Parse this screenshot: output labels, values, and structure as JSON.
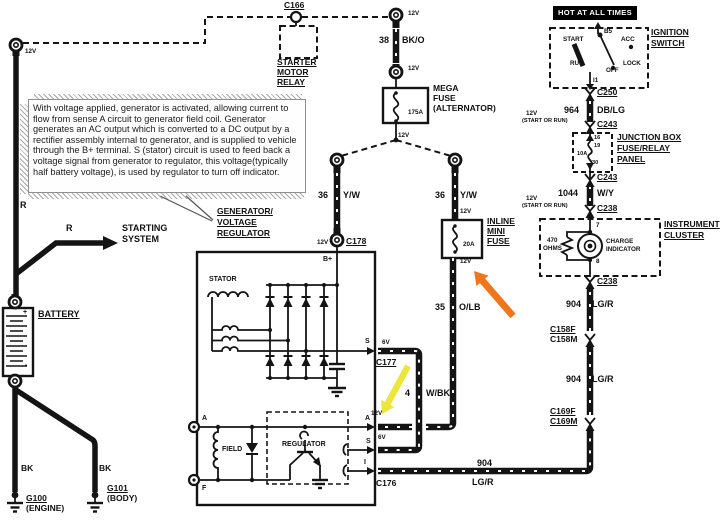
{
  "banner": {
    "hot": "HOT AT ALL TIMES"
  },
  "note": {
    "text": "With voltage applied, generator is activated, allowing current to flow from sense A circuit to generator field coil. Generator generates an AC output which is converted to a DC output by a rectifier assembly internal to generator, and is supplied to vehicle through the B+ terminal. S (stator) circuit is used to feed back a voltage signal from generator to regulator, this voltage(typically half battery voltage), is used by regulator to turn off indicator."
  },
  "ignition": {
    "title1": "IGNITION",
    "title2": "SWITCH",
    "b5": "B5",
    "start": "START",
    "acc": "ACC",
    "run": "RUN",
    "off": "OFF",
    "lock": "LOCK",
    "i1": "I1"
  },
  "relay": {
    "l1": "STARTER",
    "l2": "MOTOR",
    "l3": "RELAY"
  },
  "mega_fuse": {
    "l1": "MEGA",
    "l2": "FUSE",
    "l3": "(ALTERNATOR)",
    "rating": "175A"
  },
  "inline_fuse": {
    "l1": "INLINE",
    "l2": "MINI",
    "l3": "FUSE",
    "rating": "20A"
  },
  "junction_box": {
    "l1": "JUNCTION BOX",
    "l2": "FUSE/RELAY",
    "l3": "PANEL",
    "pin_in": "16",
    "fuse_id": "19",
    "rating": "10A",
    "pin_out": "30"
  },
  "cluster": {
    "l1": "INSTRUMENT",
    "l2": "CLUSTER",
    "pin_in": "7",
    "pin_out": "8",
    "res1": "470",
    "res2": "OHMS",
    "ind1": "CHARGE",
    "ind2": "INDICATOR"
  },
  "generator": {
    "t1": "GENERATOR/",
    "t2": "VOLTAGE",
    "t3": "REGULATOR",
    "stator": "STATOR",
    "field": "FIELD",
    "regulator": "REGULATOR",
    "bplus": "B+",
    "s_stator": "S",
    "a_right": "A",
    "s_right": "S",
    "i_right": "I",
    "a_left": "A",
    "f_left": "F"
  },
  "battery": {
    "label": "BATTERY",
    "plus": "+",
    "minus": "-"
  },
  "grounds": {
    "g100": "G100",
    "g100_sub": "(ENGINE)",
    "g101": "G101",
    "g101_sub": "(BODY)"
  },
  "starting": {
    "l1": "STARTING",
    "l2": "SYSTEM",
    "r1": "R",
    "r2": "R"
  },
  "connectors": {
    "c166": "C166",
    "c250": "C250",
    "c243_a": "C243",
    "c243_b": "C243",
    "c238_a": "C238",
    "c238_b": "C238",
    "c158f": "C158F",
    "c158m": "C158M",
    "c169f": "C169F",
    "c169m": "C169M",
    "c178": "C178",
    "c177": "C177",
    "c176": "C176"
  },
  "wires": {
    "w38_n": "38",
    "w38_c": "BK/O",
    "w36a_n": "36",
    "w36a_c": "Y/W",
    "w36b_n": "36",
    "w36b_c": "Y/W",
    "w35_n": "35",
    "w35_c": "O/LB",
    "w964_n": "964",
    "w964_c": "DB/LG",
    "w1044_n": "1044",
    "w1044_c": "W/Y",
    "w904a_n": "904",
    "w904a_c": "LG/R",
    "w904b_n": "904",
    "w904b_c": "LG/R",
    "w904c_n": "904",
    "w904c_c": "LG/R",
    "w4_n": "4",
    "w4_c": "W/BK",
    "bk_left": "BK",
    "bk_right": "BK"
  },
  "voltages": {
    "v_topleft": "12V",
    "v_topmid": "12V",
    "v_mid": "12V",
    "v_megafuse_out": "12V",
    "v_c178": "12V",
    "v_inline_in": "12V",
    "v_inline_out": "12V",
    "v_a": "12V",
    "v6_s": "6V",
    "v6_s2": "6V",
    "v_sor1": "12V",
    "sor1": "(START OR RUN)",
    "v_sor2": "12V",
    "sor2": "(START OR RUN)"
  },
  "colors": {
    "highlight_orange": "#f0761e",
    "highlight_yellow": "#ece53c",
    "banner_bg": "#000000",
    "ink": "#141414"
  }
}
